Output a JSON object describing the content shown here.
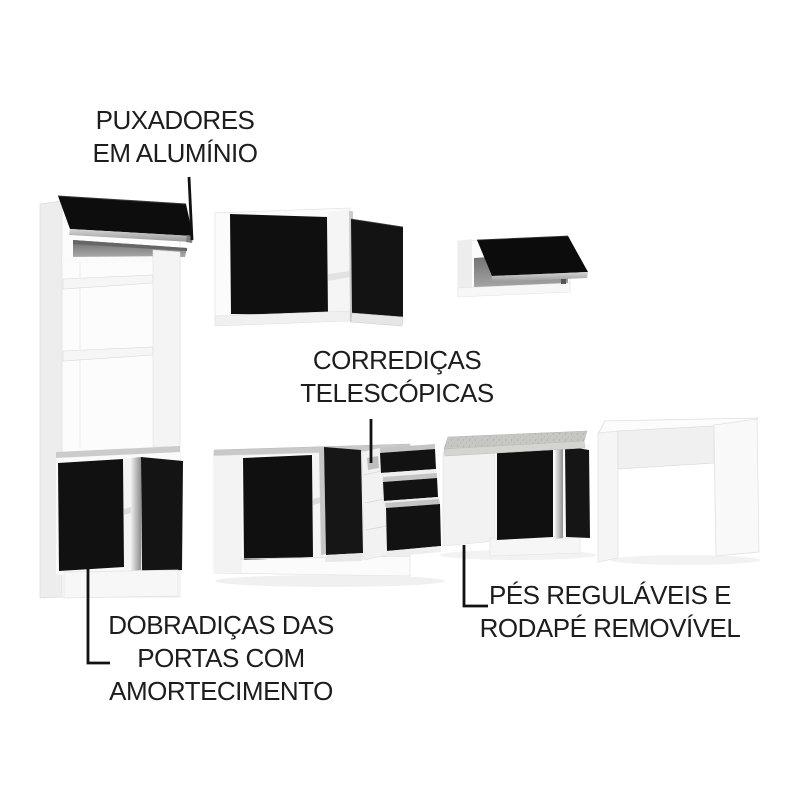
{
  "canvas": {
    "width": 800,
    "height": 800,
    "background": "#ffffff"
  },
  "callouts": {
    "handles": {
      "line1": "PUXADORES",
      "line2": "EM ALUMÍNIO"
    },
    "slides": {
      "line1": "CORREDIÇAS",
      "line2": "TELESCÓPICAS"
    },
    "hinges": {
      "line1": "DOBRADIÇAS DAS",
      "line2": "PORTAS COM",
      "line3": "AMORTECIMENTO"
    },
    "feet": {
      "line1": "PÉS REGULÁVEIS E",
      "line2": "RODAPÉ REMOVÍVEL"
    }
  },
  "colors": {
    "text": "#1d1d1d",
    "leader_line": "#111111",
    "door_black": "#111111",
    "aluminum": "#b3b3b3",
    "cabinet_white": "#fbfbfb",
    "interior_gray": "#8f8f8f",
    "countertop_gray": "#c7c7c3"
  }
}
